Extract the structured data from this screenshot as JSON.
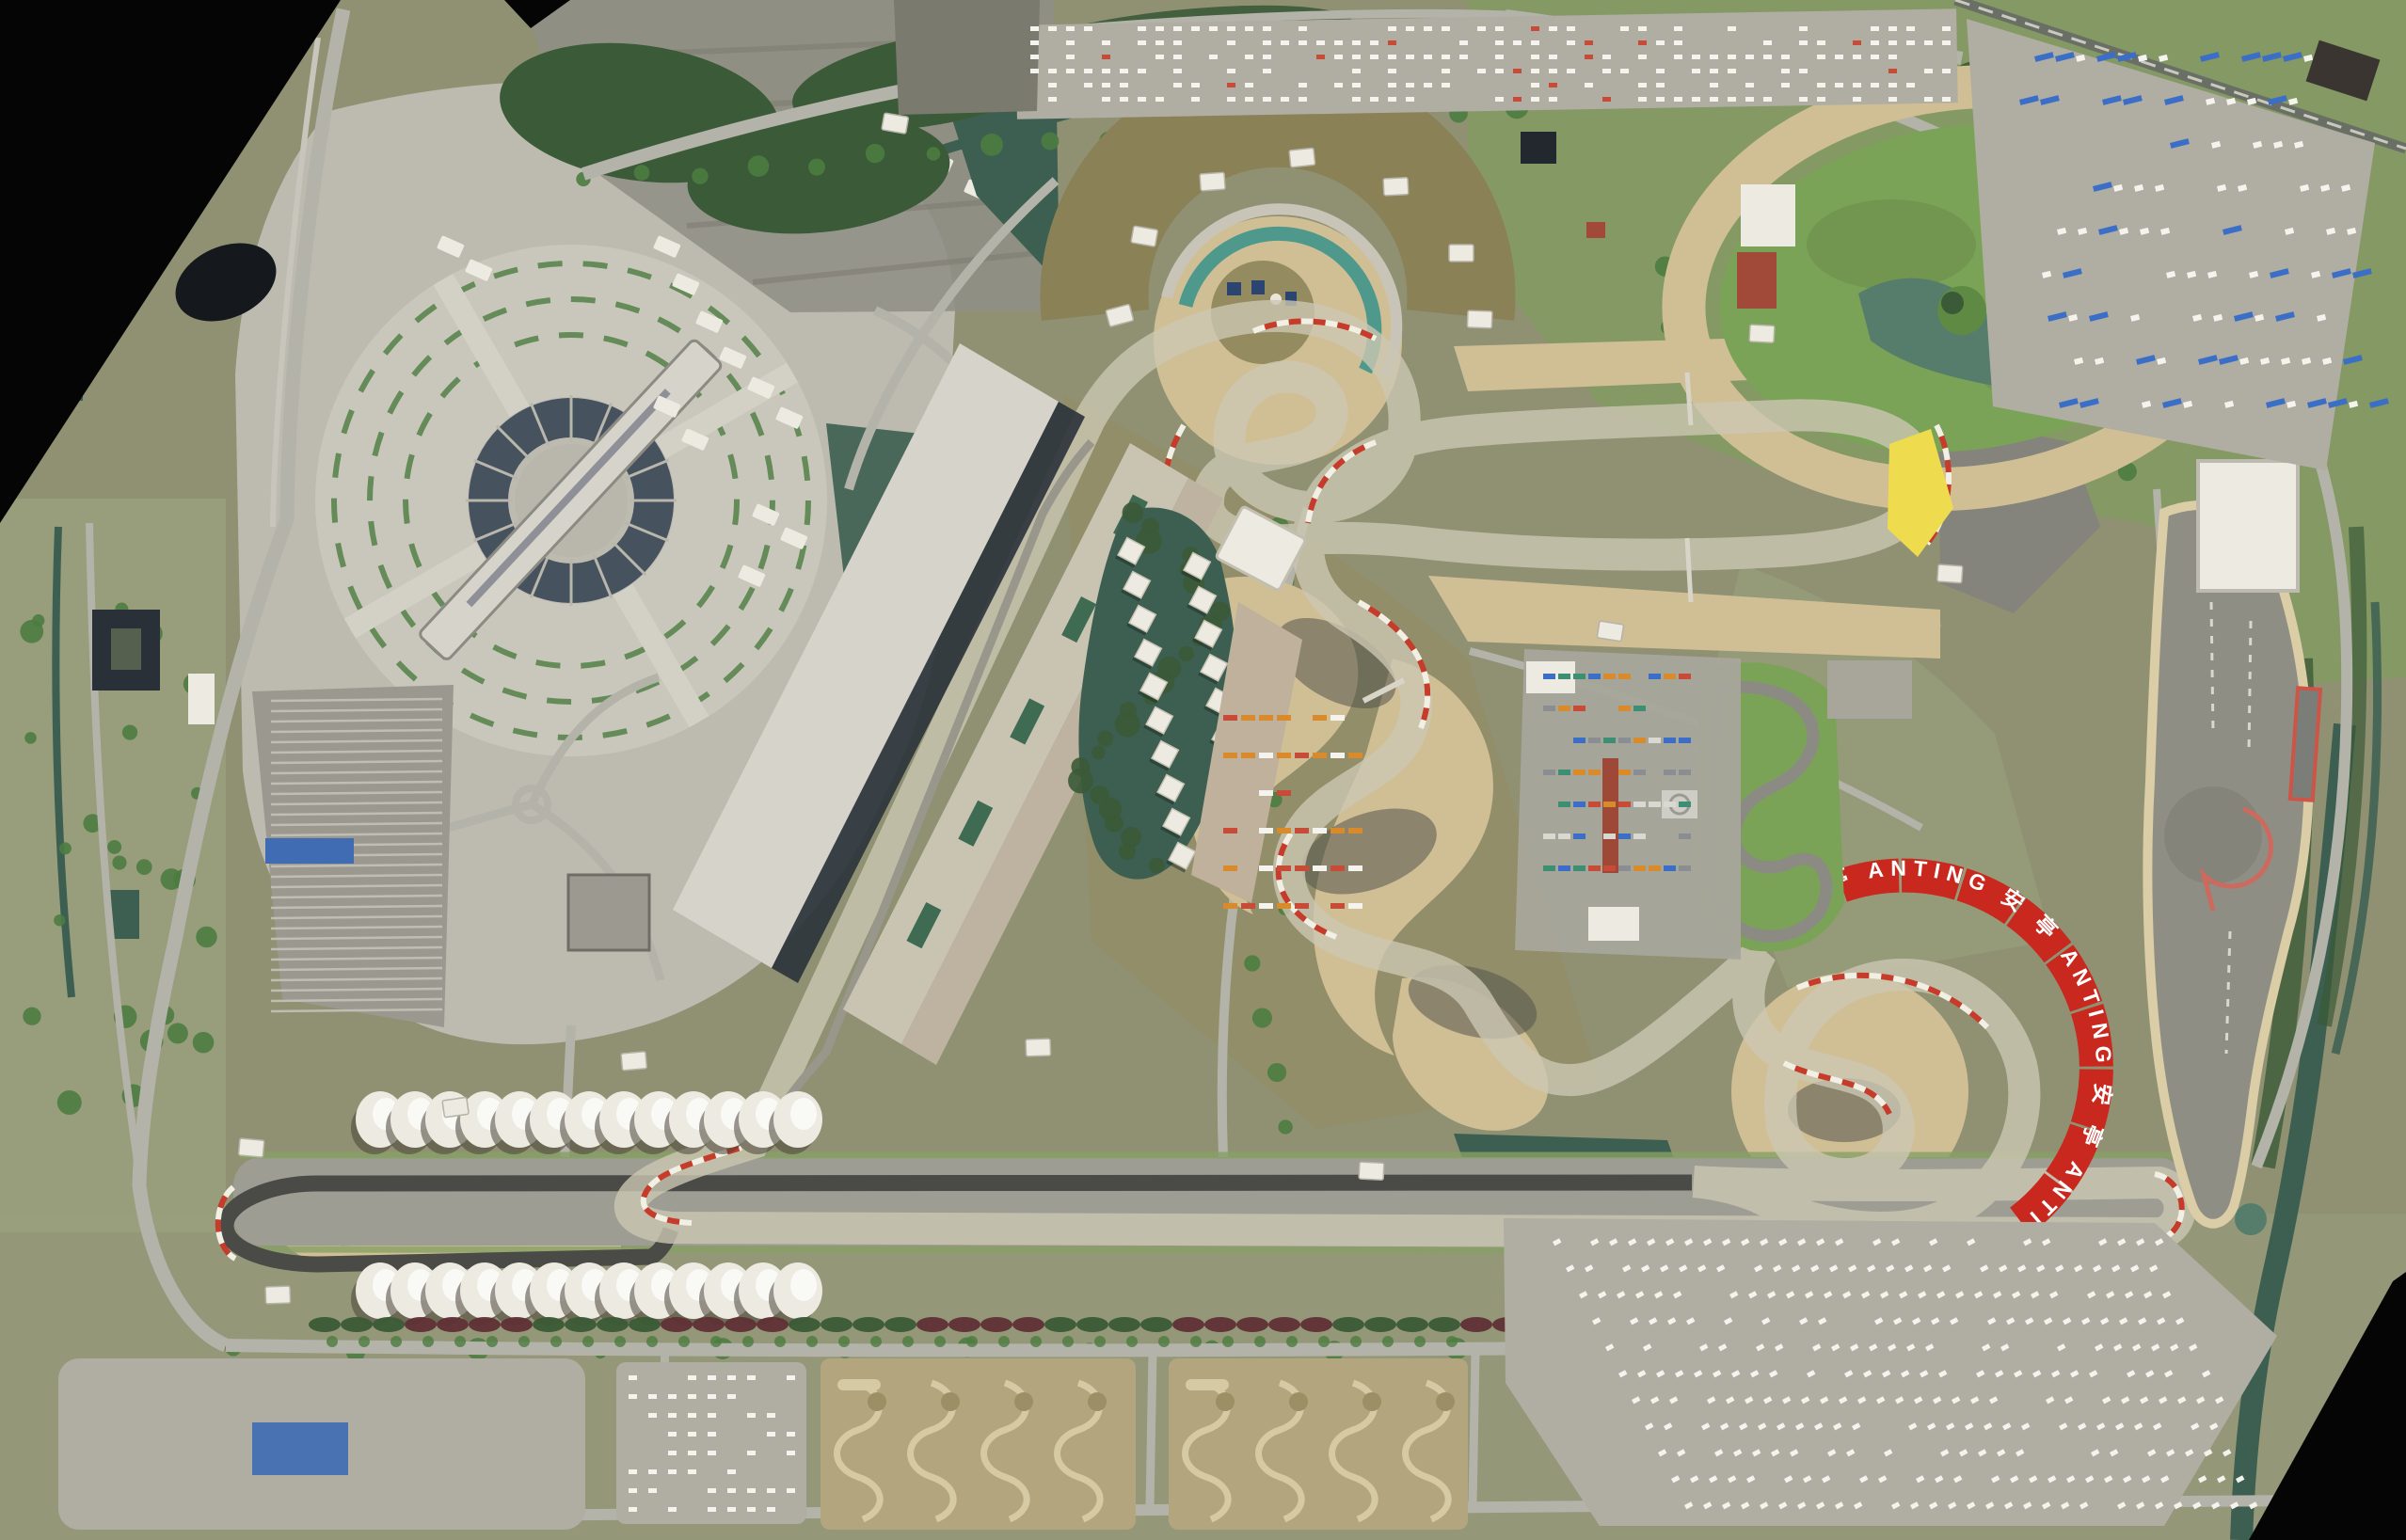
{
  "banner": {
    "segments": [
      "安",
      "亭",
      "ANTING",
      "安",
      "亭",
      "ANTING",
      "安",
      "亭",
      "ANTING"
    ],
    "display_text": "安 亭 ANTING 安 亭 ANTING 安 亭 ANTING",
    "panel_color": "#c9281e",
    "text_color": "#ffffff"
  },
  "features": {
    "grandstand_dome_rows": 2,
    "domes_per_row": 13,
    "paddock_pavilions": 19,
    "plaza_hedge_rings": 3,
    "pit_garage_sections": 5
  },
  "palette": {
    "void_black": "#050505",
    "field_olive": "#8f9172",
    "field_olive_light": "#9aa07e",
    "grass_bright": "#7ba357",
    "grass_dark": "#5f8a44",
    "dry_grass": "#948c60",
    "banking_brown": "#8a8157",
    "forest": "#3b5a37",
    "tree": "#4c7c40",
    "hedge_red": "#5f2f35",
    "water": "#3c5f51",
    "water_light": "#567d6c",
    "sand": "#d0bf95",
    "sand_light": "#dbcda6",
    "asphalt_track": "#5c5c57",
    "asphalt_dark": "#4a4a46",
    "apron_grey": "#a8a69b",
    "plaza_grey": "#bdbbb0",
    "plaza_light": "#c9c7bc",
    "road_grey": "#b3b3aa",
    "lot_grey": "#b0ada3",
    "lot_dark": "#8f8e86",
    "roof_white": "#eceae1",
    "roof_grandstand": "#d6d4ca",
    "shadow": "#2e353c",
    "panel_blue": "#47525f",
    "kerb_red": "#c63b2a",
    "kerb_white": "#f2efe4",
    "teal_stand": "#4e998c",
    "yellow_patch": "#efdc4e",
    "roof_red": "#a14a3a",
    "roof_blue": "#3f6cb2",
    "bus_blue": "#3b6ec6",
    "car_white": "#f4f3ee"
  }
}
